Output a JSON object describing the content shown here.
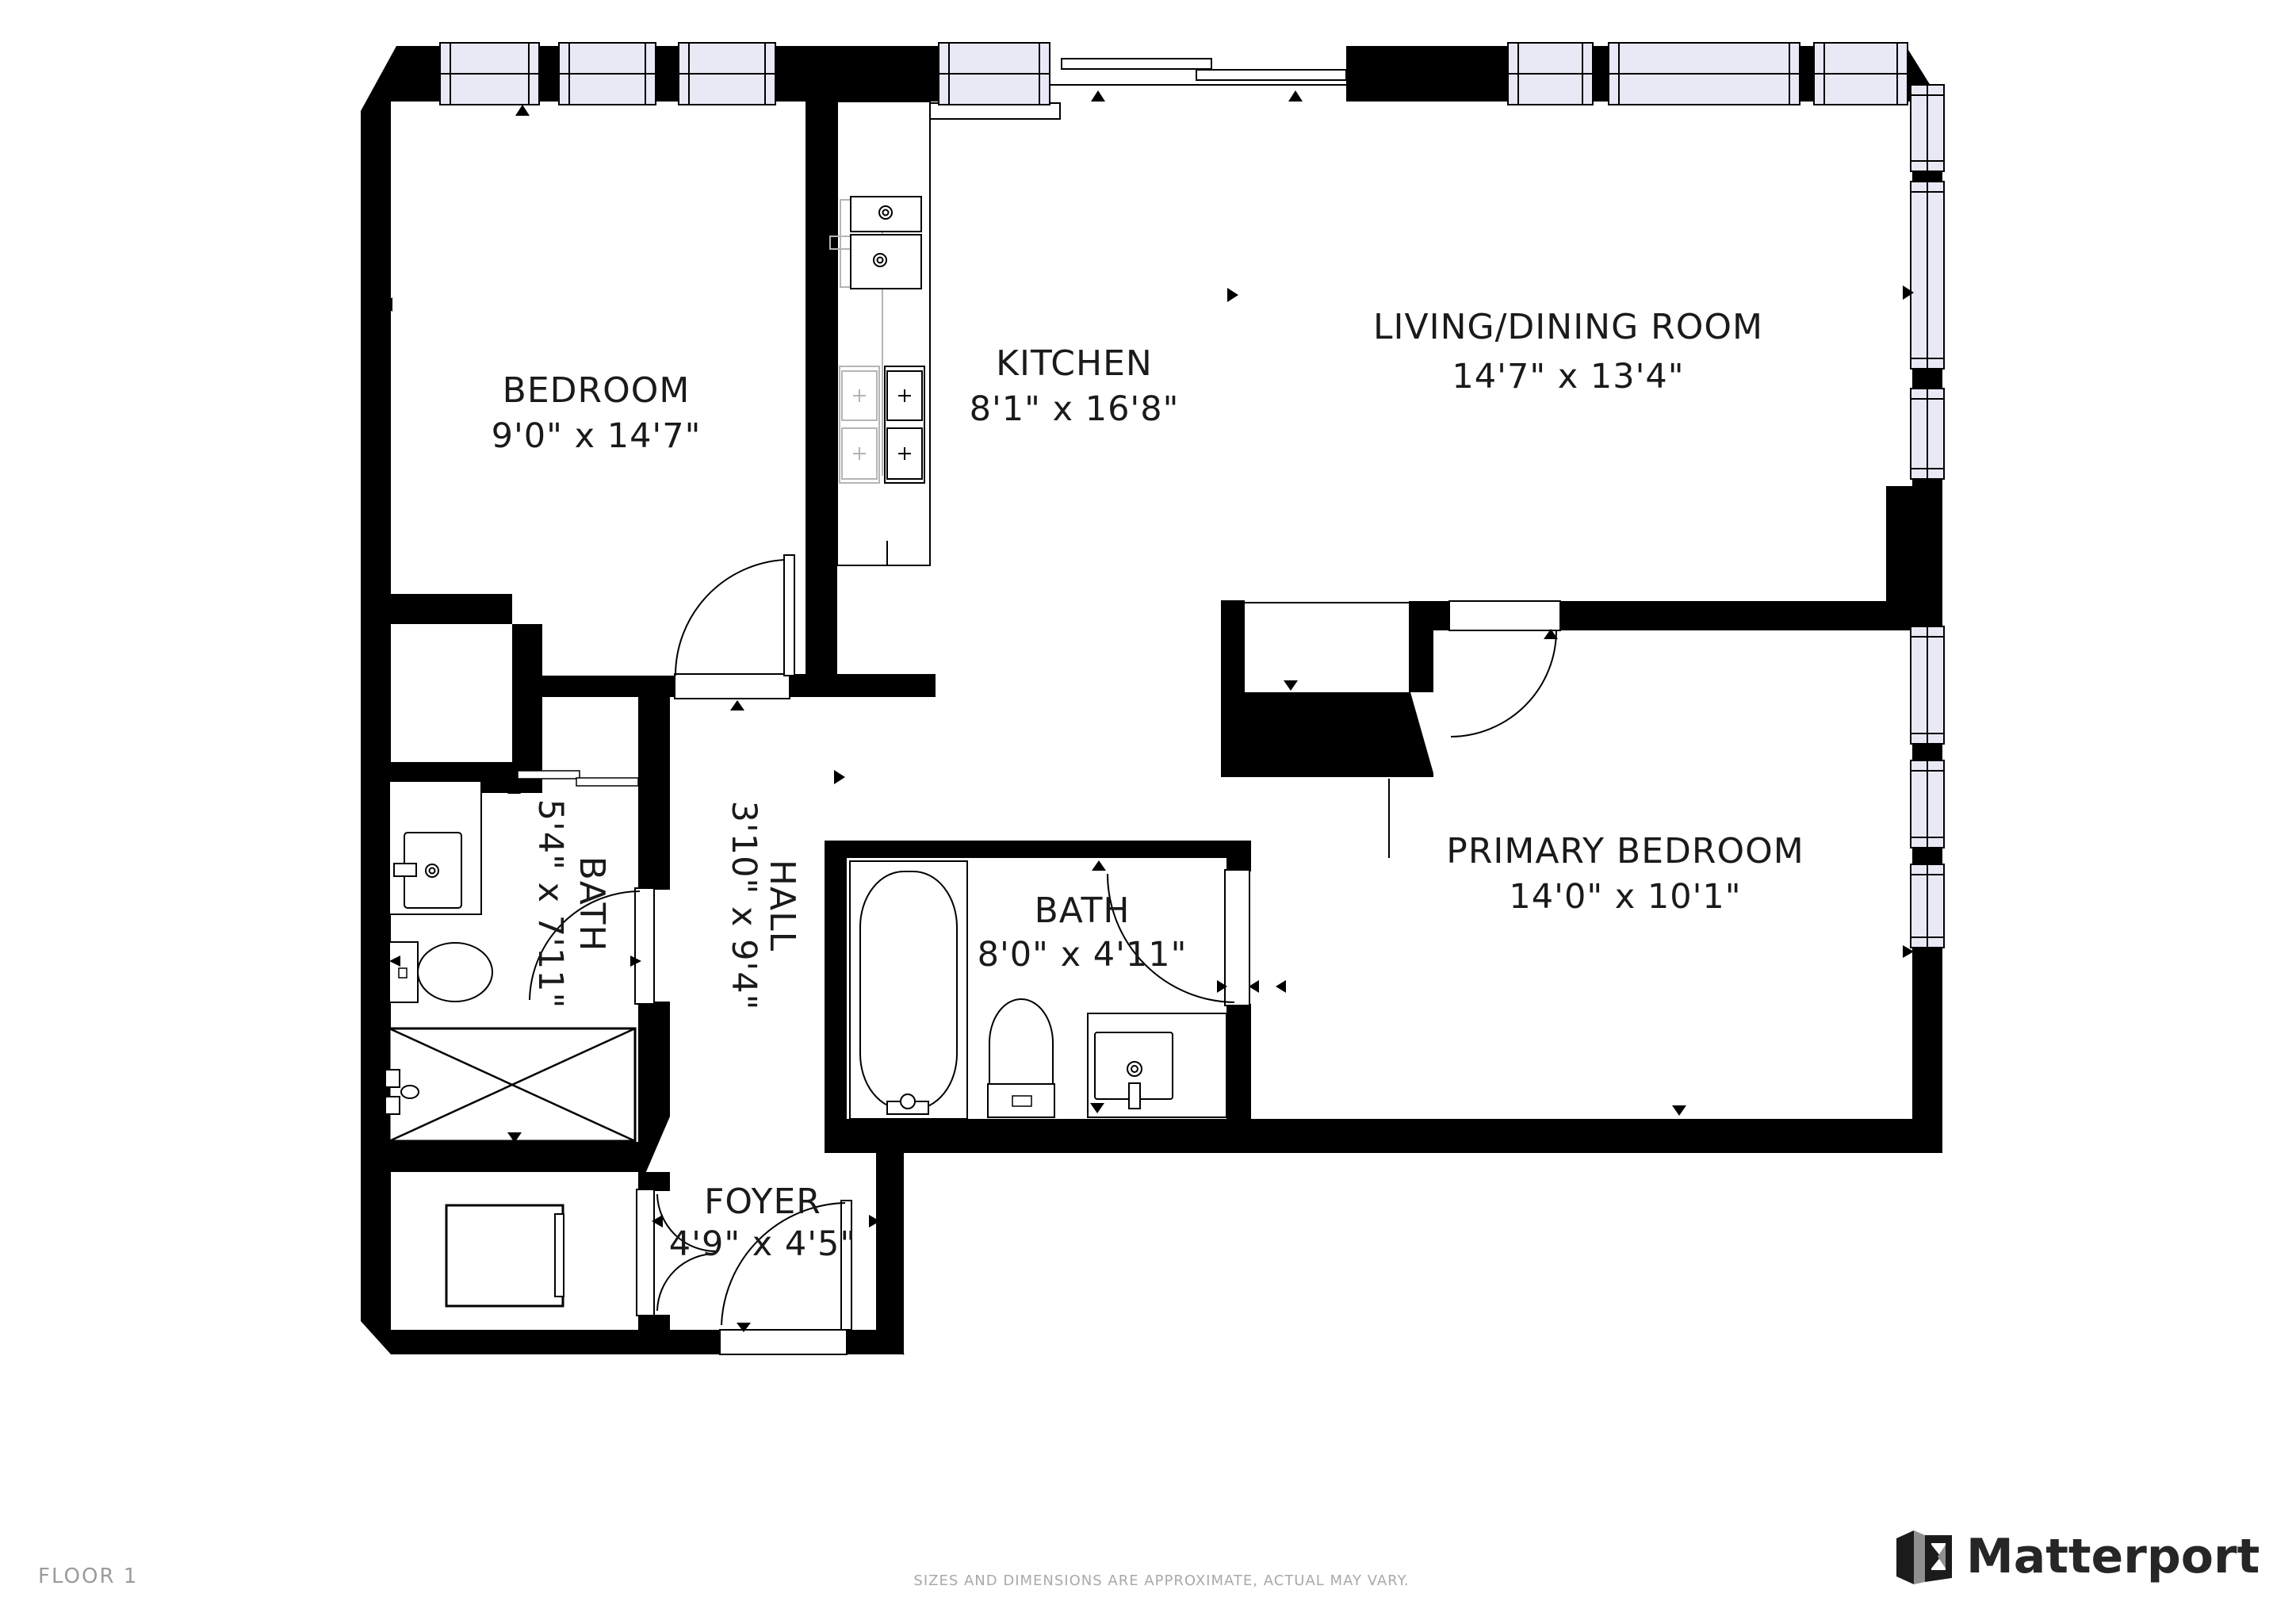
{
  "rooms": {
    "bedroom": {
      "name": "BEDROOM",
      "dimensions": "9'0\" x 14'7\""
    },
    "kitchen": {
      "name": "KITCHEN",
      "dimensions": "8'1\" x 16'8\""
    },
    "living": {
      "name": "LIVING/DINING ROOM",
      "dimensions": "14'7\" x 13'4\""
    },
    "primary": {
      "name": "PRIMARY BEDROOM",
      "dimensions": "14'0\" x 10'1\""
    },
    "bath_hall": {
      "name": "BATH",
      "dimensions": "5'4\" x 7'11\"",
      "orientation": "rotated-90"
    },
    "hall": {
      "name": "HALL",
      "dimensions": "3'10\" x 9'4\"",
      "orientation": "rotated-90"
    },
    "bath_primary": {
      "name": "BATH",
      "dimensions": "8'0\" x 4'11\""
    },
    "foyer": {
      "name": "FOYER",
      "dimensions": "4'9\" x 4'5\""
    }
  },
  "footer": {
    "floor_label": "FLOOR 1",
    "disclaimer": "SIZES AND DIMENSIONS ARE APPROXIMATE, ACTUAL MAY VARY."
  },
  "brand": {
    "name": "Matterport"
  },
  "colors": {
    "wall": "#000000",
    "window_fill": "#e9e9f6",
    "line": "#000000",
    "fixture_gray": "#b5b5b5",
    "label": "#1a1a1a",
    "footer_text": "#9b9b9b",
    "disclaimer_text": "#a9a9a9",
    "logo_text": "#262626"
  }
}
